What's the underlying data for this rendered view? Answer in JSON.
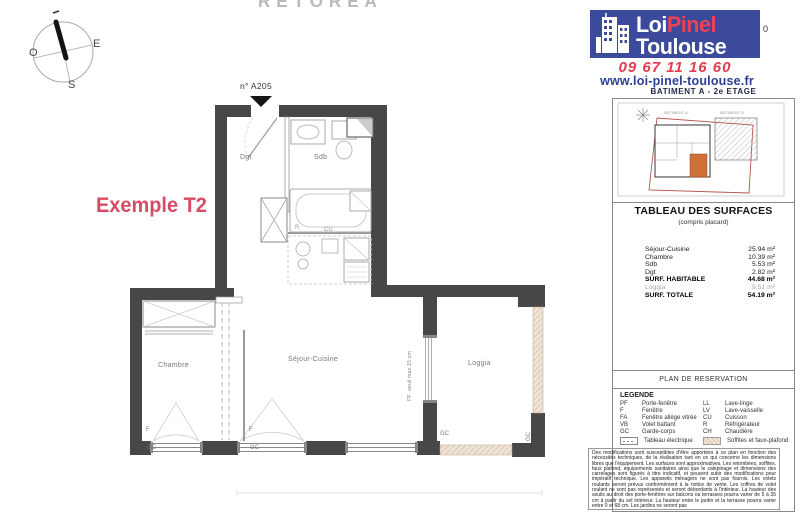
{
  "watermark": "RETOREA",
  "compass": {
    "west": "O",
    "east": "E",
    "south": "S"
  },
  "plan": {
    "example_label": "Exemple T2",
    "unit_number": "n° A205",
    "rooms": [
      {
        "name": "Dgt"
      },
      {
        "name": "Sdb"
      },
      {
        "name": "Chambre"
      },
      {
        "name": "Séjour-Cuisine"
      },
      {
        "name": "Loggia"
      }
    ],
    "annotations": {
      "window_f_1": "F",
      "window_f_2": "F",
      "gc_1": "GC",
      "gc_2": "GC",
      "gc_3": "GC",
      "gc_4": "GC",
      "fridge": "R",
      "cooking": "CU",
      "pf_seuil": "PF  seuil max 15 cm"
    }
  },
  "sidebar": {
    "logo": {
      "word1": "Loi",
      "word2": "Pinel",
      "word3": "Toulouse"
    },
    "artifact_zero": "0",
    "phone": "09 67 11 16 60",
    "website": "www.loi-pinel-toulouse.fr",
    "building_floor": "BATIMENT A - 2e ETAGE",
    "site_plan": {
      "building_a_label": "BÂTIMENT A",
      "building_b_label": "BÂTIMENT B"
    },
    "surface_table": {
      "title": "TABLEAU DES SURFACES",
      "subtitle": "(compris placard)",
      "rows": [
        {
          "label": "Séjour-Cuisine",
          "value": "25.94 m²",
          "style": "normal"
        },
        {
          "label": "Chambre",
          "value": "10.39 m²",
          "style": "normal"
        },
        {
          "label": "Sdb",
          "value": "5.53 m²",
          "style": "normal"
        },
        {
          "label": "Dgt",
          "value": "2.82 m²",
          "style": "normal"
        },
        {
          "label": "SURF. HABITABLE",
          "value": "44.68 m²",
          "style": "bold"
        },
        {
          "label": "Loggia",
          "value": "9.51 m²",
          "style": "muted"
        },
        {
          "label": "SURF. TOTALE",
          "value": "54.19 m²",
          "style": "bold"
        }
      ]
    },
    "reservation_banner": "PLAN DE RESERVATION",
    "legend": {
      "title": "LEGENDE",
      "col1": [
        {
          "abbr": "PF",
          "label": "Porte-fenêtre"
        },
        {
          "abbr": "F",
          "label": "Fenêtre"
        },
        {
          "abbr": "FA",
          "label": "Fenêtre allège vitrée"
        },
        {
          "abbr": "VB",
          "label": "Volet battant"
        },
        {
          "abbr": "GC",
          "label": "Garde-corps"
        }
      ],
      "col2": [
        {
          "abbr": "LL",
          "label": "Lave-linge"
        },
        {
          "abbr": "LV",
          "label": "Lave-vaisselle"
        },
        {
          "abbr": "CU",
          "label": "Cuisson"
        },
        {
          "abbr": "R",
          "label": "Réfrigérateur"
        },
        {
          "abbr": "CH",
          "label": "Chaudière"
        }
      ],
      "symbols": [
        {
          "label": "Tableau électrique"
        },
        {
          "label": "Soffites et faux-plafond"
        }
      ]
    },
    "disclaimer": "Des modifications sont susceptibles d'être apportées à ce plan en fonction des nécessités techniques, de la réalisation tant en ce qui concerne les dimensions libres que l'équipement. Les surfaces sont approximatives. Les retombées, soffites, faux plafond, équipements sanitaires ainsi que le calepinage et dimensions des carrelages sont figurés à titre indicatif, et peuvent subir des modifications pour impératif technique. Les appareils ménagers ne sont pas fournis. Les volets roulants seront prévus conformément à la notice de vente. Les coffres de volet roulant ne sont pas représentés et seront débordants à l'intérieur. La hauteur des seuils au droit des porte-fenêtres sur balcons ou terrasses pourra varier de 5 à 35 cm à partir du sol intérieur. La hauteur entre le jardin et la terrasse pourra varier entre 0 et 68 cm. Les jardins ne seront pas"
  },
  "colors": {
    "brand_blue": "#3b4a9a",
    "brand_red": "#e23b4f",
    "navy": "#2c3f96",
    "plan_wall": "#474747",
    "accent_pink": "#d84b64",
    "site_unit_orange": "#d2703a",
    "parcel_red": "#b5544a",
    "rail_beige": "#f0e4d4"
  }
}
